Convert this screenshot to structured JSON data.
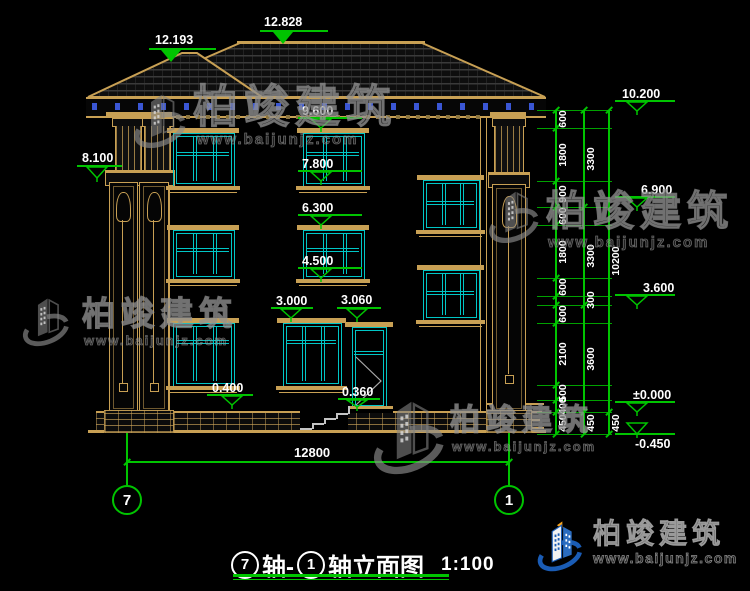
{
  "title": {
    "axis_from": "7",
    "mid": "轴-",
    "axis_to": "1",
    "suffix": "轴立面图",
    "scale": "1:100"
  },
  "watermark": {
    "brand": "柏竣建筑",
    "url": "www.baijunjz.com"
  },
  "footer_logo": {
    "brand": "柏竣建筑",
    "url": "www.baijunjz.com"
  },
  "axis_bubbles": {
    "left": "7",
    "right": "1"
  },
  "bottom_dim": {
    "label": "12800",
    "x1": 127,
    "x2": 509,
    "y": 461,
    "text_x": 294,
    "text_y": 445
  },
  "colors": {
    "line_tan": "#c8a054",
    "window_cyan": "#00c6c6",
    "dim_green": "#00c400",
    "accent_blue": "#3a56d4",
    "text_white": "#ffffff",
    "logo_blue": "#1a5cb5",
    "logo_orange": "#f7a21b"
  },
  "markers": [
    {
      "label": "12.193",
      "tx": 155,
      "ty": 33,
      "ax": 149,
      "aw": 67,
      "ay": 49,
      "tcx": 171,
      "tip": 62,
      "filled": true
    },
    {
      "label": "12.828",
      "tx": 264,
      "ty": 15,
      "ax": 260,
      "aw": 68,
      "ay": 31,
      "tcx": 283,
      "tip": 44,
      "filled": true
    },
    {
      "label": "8.100",
      "tx": 82,
      "ty": 151,
      "ax": 77,
      "aw": 45,
      "ay": 166,
      "tcx": 97,
      "tip": 178
    },
    {
      "label": "9.600",
      "tx": 302,
      "ty": 104,
      "ax": 298,
      "aw": 64,
      "ay": 118,
      "tcx": 321,
      "tip": 128
    },
    {
      "label": "7.800",
      "tx": 302,
      "ty": 157,
      "ax": 298,
      "aw": 64,
      "ay": 171,
      "tcx": 321,
      "tip": 181
    },
    {
      "label": "6.300",
      "tx": 302,
      "ty": 201,
      "ax": 298,
      "aw": 64,
      "ay": 215,
      "tcx": 321,
      "tip": 225
    },
    {
      "label": "4.500",
      "tx": 302,
      "ty": 254,
      "ax": 298,
      "aw": 64,
      "ay": 268,
      "tcx": 321,
      "tip": 278
    },
    {
      "label": "3.000",
      "tx": 276,
      "ty": 294,
      "ax": 271,
      "aw": 42,
      "ay": 308,
      "tcx": 291,
      "tip": 318
    },
    {
      "label": "3.060",
      "tx": 341,
      "ty": 293,
      "ax": 337,
      "aw": 44,
      "ay": 308,
      "tcx": 357,
      "tip": 318
    },
    {
      "label": "0.400",
      "tx": 212,
      "ty": 381,
      "ax": 207,
      "aw": 46,
      "ay": 395,
      "tcx": 232,
      "tip": 405
    },
    {
      "label": "0.360",
      "tx": 342,
      "ty": 385,
      "ax": 338,
      "aw": 42,
      "ay": 399,
      "tcx": 357,
      "tip": 407
    },
    {
      "label": "10.200",
      "tx": 622,
      "ty": 87,
      "ax": 615,
      "aw": 60,
      "ay": 101,
      "tcx": 637,
      "tip": 111
    },
    {
      "label": "6.900",
      "tx": 641,
      "ty": 183,
      "ax": 615,
      "aw": 60,
      "ay": 197,
      "tcx": 637,
      "tip": 207
    },
    {
      "label": "3.600",
      "tx": 643,
      "ty": 281,
      "ax": 615,
      "aw": 60,
      "ay": 295,
      "tcx": 637,
      "tip": 305
    },
    {
      "label": "±0.000",
      "tx": 633,
      "ty": 388,
      "ax": 615,
      "aw": 60,
      "ay": 402,
      "tcx": 637,
      "tip": 412
    },
    {
      "label": "-0.450",
      "tx": 635,
      "ty": 437,
      "ax": 615,
      "aw": 60,
      "ay": 434,
      "tcx": 637,
      "tip": 422,
      "text_below": true
    }
  ],
  "dim_chains": {
    "ext_x1": 537,
    "ext_x2": 612,
    "cols": [
      {
        "x": 555,
        "bounds": [
          110,
          128,
          181,
          207,
          225,
          278,
          296,
          305,
          323,
          385,
          400,
          412,
          434
        ],
        "labels": [
          "600",
          "1800",
          "900",
          "600",
          "1800",
          "600",
          "",
          "600",
          "2100",
          "500",
          "400",
          "450"
        ]
      },
      {
        "x": 583,
        "bounds": [
          110,
          207,
          305,
          412,
          434
        ],
        "labels": [
          "3300",
          "3300",
          "3600",
          "450"
        ]
      },
      {
        "x": 608,
        "bounds": [
          110,
          412,
          434
        ],
        "labels": [
          "10200",
          "450"
        ]
      }
    ],
    "offset_label": {
      "text": "300",
      "x": 591,
      "y": 300
    }
  },
  "windows": [
    {
      "name": "window-3f-left",
      "x": 173,
      "y": 133,
      "w": 60,
      "h": 52,
      "t": 0.37
    },
    {
      "name": "window-3f-mid",
      "x": 303,
      "y": 133,
      "w": 60,
      "h": 52,
      "t": 0.37
    },
    {
      "name": "window-stair-upper",
      "x": 423,
      "y": 180,
      "w": 55,
      "h": 49,
      "t": 0.42
    },
    {
      "name": "window-2f-left",
      "x": 173,
      "y": 230,
      "w": 60,
      "h": 48,
      "t": 0.37
    },
    {
      "name": "window-2f-mid",
      "x": 303,
      "y": 230,
      "w": 60,
      "h": 48,
      "t": 0.37
    },
    {
      "name": "window-stair-lower",
      "x": 423,
      "y": 270,
      "w": 55,
      "h": 49,
      "t": 0.42
    },
    {
      "name": "window-1f-left",
      "x": 173,
      "y": 323,
      "w": 60,
      "h": 62,
      "t": 0.28
    },
    {
      "name": "window-1f-mid",
      "x": 283,
      "y": 323,
      "w": 57,
      "h": 62,
      "t": 0.28
    }
  ],
  "watermarks": [
    {
      "x": 133,
      "y": 82,
      "lw": 54,
      "lh": 76,
      "tdx": 60,
      "tdy": 2,
      "font": 45,
      "udx": 64,
      "udy": 50,
      "ufont": 15
    },
    {
      "x": 488,
      "y": 183,
      "lw": 52,
      "lh": 66,
      "tdx": 58,
      "tdy": 8,
      "font": 41,
      "udx": 60,
      "udy": 52,
      "ufont": 15
    },
    {
      "x": 20,
      "y": 292,
      "lw": 52,
      "lh": 58,
      "tdx": 62,
      "tdy": 5,
      "font": 33,
      "udx": 64,
      "udy": 42,
      "ufont": 13
    },
    {
      "x": 370,
      "y": 392,
      "lw": 78,
      "lh": 88,
      "tdx": 80,
      "tdy": 14,
      "font": 30,
      "udx": 82,
      "udy": 48,
      "ufont": 13
    }
  ]
}
